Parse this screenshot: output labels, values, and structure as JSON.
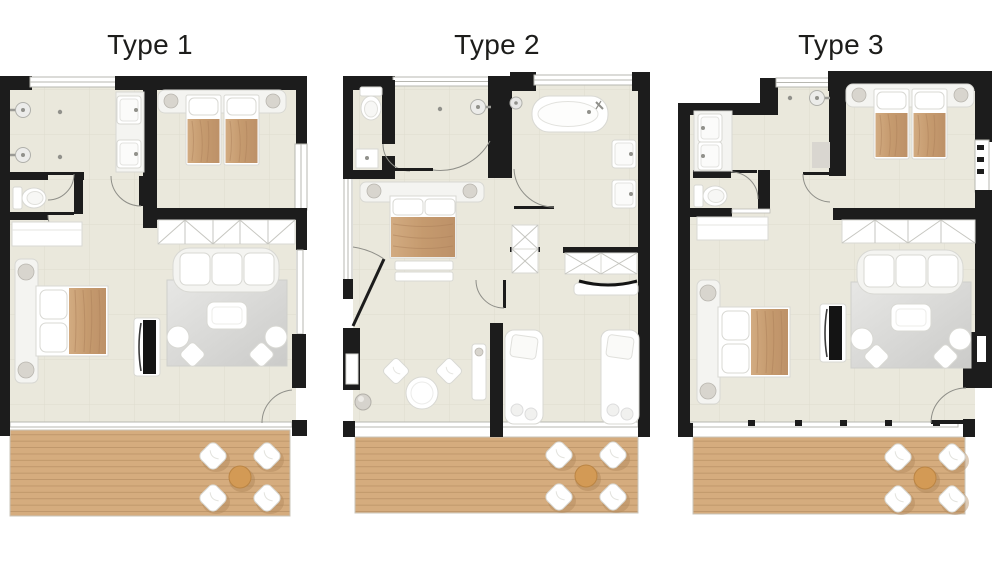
{
  "page": {
    "background": "#ffffff"
  },
  "units": [
    {
      "id": "type-1",
      "title": "Type 1"
    },
    {
      "id": "type-2",
      "title": "Type 2"
    },
    {
      "id": "type-3",
      "title": "Type 3"
    }
  ],
  "colors": {
    "page-bg": "#ffffff",
    "title": "#1d1d1b",
    "wall": "#1c1c1c",
    "floor": "#eae8dc",
    "tile-line": "#dedcce",
    "wood": "#d5ac7e",
    "wood-line": "#bd9569",
    "blanket": "#cda67b",
    "furniture": "#ffffff",
    "furniture-line": "#d8d8d3",
    "rug": "#dcdcda",
    "terrace-table": "#d39a55"
  }
}
